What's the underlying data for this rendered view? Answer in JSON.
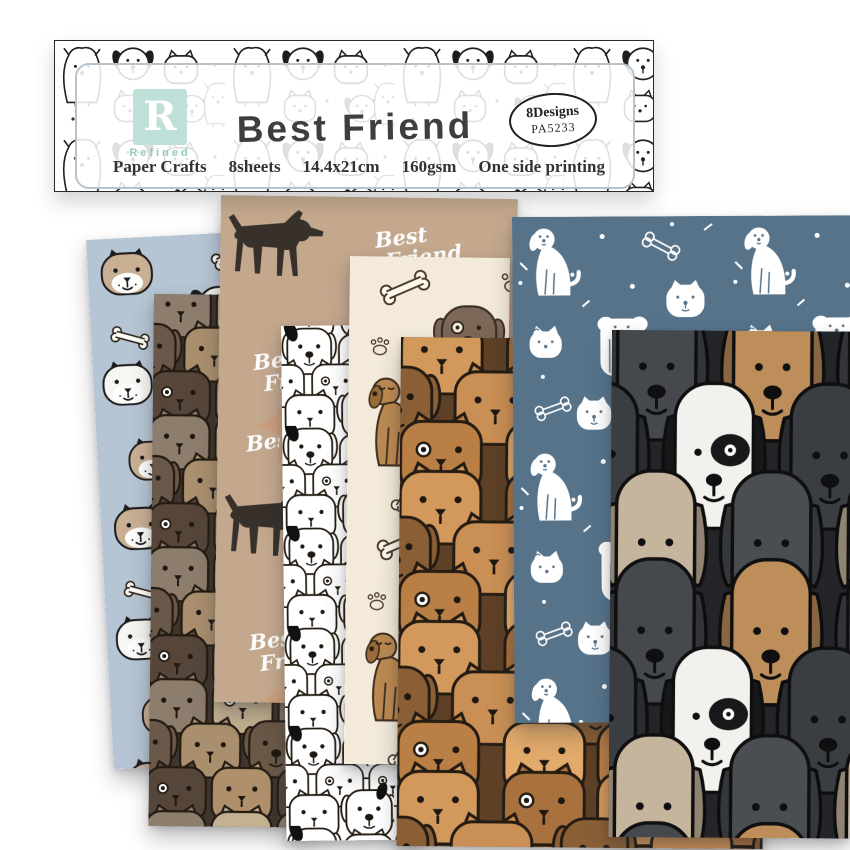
{
  "banner": {
    "logo": {
      "letter": "R",
      "name": "Refined"
    },
    "title": "Best Friend",
    "badge": {
      "designs": "8Designs",
      "code": "PA5233"
    },
    "specs": [
      "Paper Crafts",
      "8sheets",
      "14.4x21cm",
      "160gsm",
      "One side printing"
    ]
  },
  "tan_text": {
    "line1": "Best",
    "line2": "Friend"
  },
  "sheets": [
    {
      "name": "blue-dog-faces",
      "label": "light blue paper with dog faces and bones",
      "base_color": "#b6c5d3"
    },
    {
      "name": "brown-dog-crowd",
      "label": "packed crowd of brown and taupe dogs",
      "base_color": "#3e352c",
      "palette": [
        "#8d7d6c",
        "#c4b191",
        "#a98f6e",
        "#6a5848",
        "#56463a",
        "#b0906c"
      ]
    },
    {
      "name": "tan-best-friend",
      "label": "tan paper with dog silhouettes and Best Friend script",
      "base_color": "#c4a88e",
      "palette": [
        "#37302b",
        "#cb9f7e"
      ]
    },
    {
      "name": "black-white-doodle-crowd",
      "label": "white paper with black outline dog crowd",
      "base_color": "#ffffff"
    },
    {
      "name": "cream-bones-paws",
      "label": "cream paper with dog heads, bones and paw prints",
      "base_color": "#f3ead9",
      "palette": [
        "#7c6858",
        "#bc8a52",
        "#473627"
      ]
    },
    {
      "name": "caramel-dog-crowd",
      "label": "caramel crowd of big dog heads",
      "base_color": "#5d4026",
      "palette": [
        "#d2985c",
        "#a9713d",
        "#c98f54",
        "#8a5f36",
        "#b97f45",
        "#e2aa6b"
      ]
    },
    {
      "name": "slate-white-doodles",
      "label": "slate blue paper with white doodle dogs, bones and dots",
      "base_color": "#56738a"
    },
    {
      "name": "charcoal-dog-crowd",
      "label": "charcoal crowd of large grey, tan and white dogs",
      "base_color": "#232529",
      "palette": [
        "#45484d",
        "#bd8d5a",
        "#c6b59d",
        "#f2f1ed",
        "#3a3d42"
      ]
    }
  ]
}
